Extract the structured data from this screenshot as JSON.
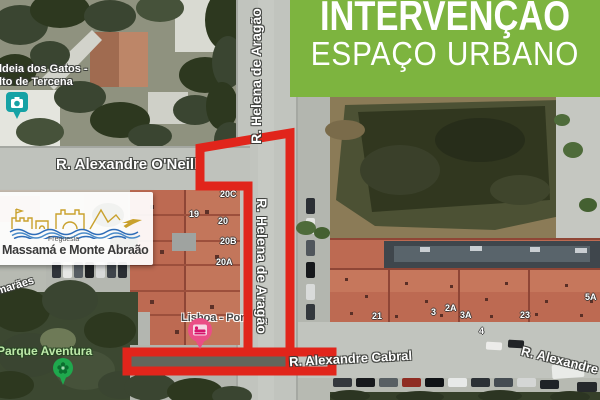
{
  "poster": {
    "title_line1": "INTERVENÇÃO",
    "title_line2": "ESPAÇO URBANO",
    "panel_color": "#7db43f",
    "intervention_outline_color": "#e1251b",
    "intervention_area_number": "1"
  },
  "logo": {
    "org_small": "Freguesia",
    "org_name": "Massamá e Monte Abraão",
    "art_gold_color": "#c9a12d",
    "art_wave_color": "#2f6db8"
  },
  "map": {
    "streets": {
      "aldeia_line1": "Aldeia dos Gatos -",
      "aldeia_line2": "Alto de Tercena",
      "oneill": "R. Alexandre O'Neill",
      "helena_top": "R. Helena de Aragão",
      "helena_mid": "R. Helena de Aragão",
      "cabral": "R. Alexandre Cabral",
      "cabral_right": "R. Alexandre Ca",
      "guimaraes": "marães",
      "parque": "Parque Aventura",
      "lisboa": "Lisboa - Portugal"
    },
    "house_numbers": [
      {
        "text": "20C",
        "x": 220,
        "y": 189
      },
      {
        "text": "19",
        "x": 189,
        "y": 209
      },
      {
        "text": "20",
        "x": 218,
        "y": 216
      },
      {
        "text": "20B",
        "x": 220,
        "y": 236
      },
      {
        "text": "20A",
        "x": 216,
        "y": 257
      },
      {
        "text": "21",
        "x": 372,
        "y": 311
      },
      {
        "text": "3",
        "x": 431,
        "y": 307
      },
      {
        "text": "2A",
        "x": 445,
        "y": 303
      },
      {
        "text": "3A",
        "x": 460,
        "y": 310
      },
      {
        "text": "4",
        "x": 479,
        "y": 326
      },
      {
        "text": "23",
        "x": 520,
        "y": 310
      },
      {
        "text": "5A",
        "x": 585,
        "y": 292
      }
    ],
    "markers": [
      {
        "type": "photo-spot",
        "color": "#16a2a5"
      },
      {
        "type": "hotel",
        "color": "#ea4e86"
      },
      {
        "type": "park",
        "color": "#1fa84d"
      }
    ]
  }
}
